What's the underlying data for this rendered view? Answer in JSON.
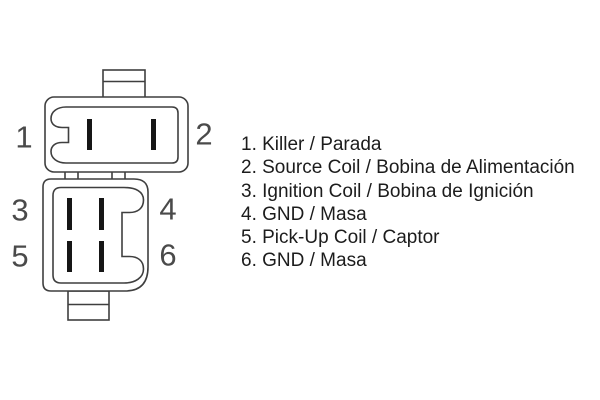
{
  "pins": [
    {
      "number": "1"
    },
    {
      "number": "2"
    },
    {
      "number": "3"
    },
    {
      "number": "4"
    },
    {
      "number": "5"
    },
    {
      "number": "6"
    }
  ],
  "legend": {
    "items": [
      {
        "text": "1. Killer / Parada"
      },
      {
        "text": "2. Source Coil / Bobina de Alimentación"
      },
      {
        "text": "3. Ignition Coil / Bobina de Ignición"
      },
      {
        "text": "4. GND / Masa"
      },
      {
        "text": "5. Pick-Up Coil / Captor"
      },
      {
        "text": "6. GND / Masa"
      }
    ]
  },
  "colors": {
    "background": "#ffffff",
    "outline": "#3f3f3f",
    "pin-fill": "#161616",
    "pin-number": "#4a4a4a",
    "legend-text": "#1c1c1c"
  }
}
